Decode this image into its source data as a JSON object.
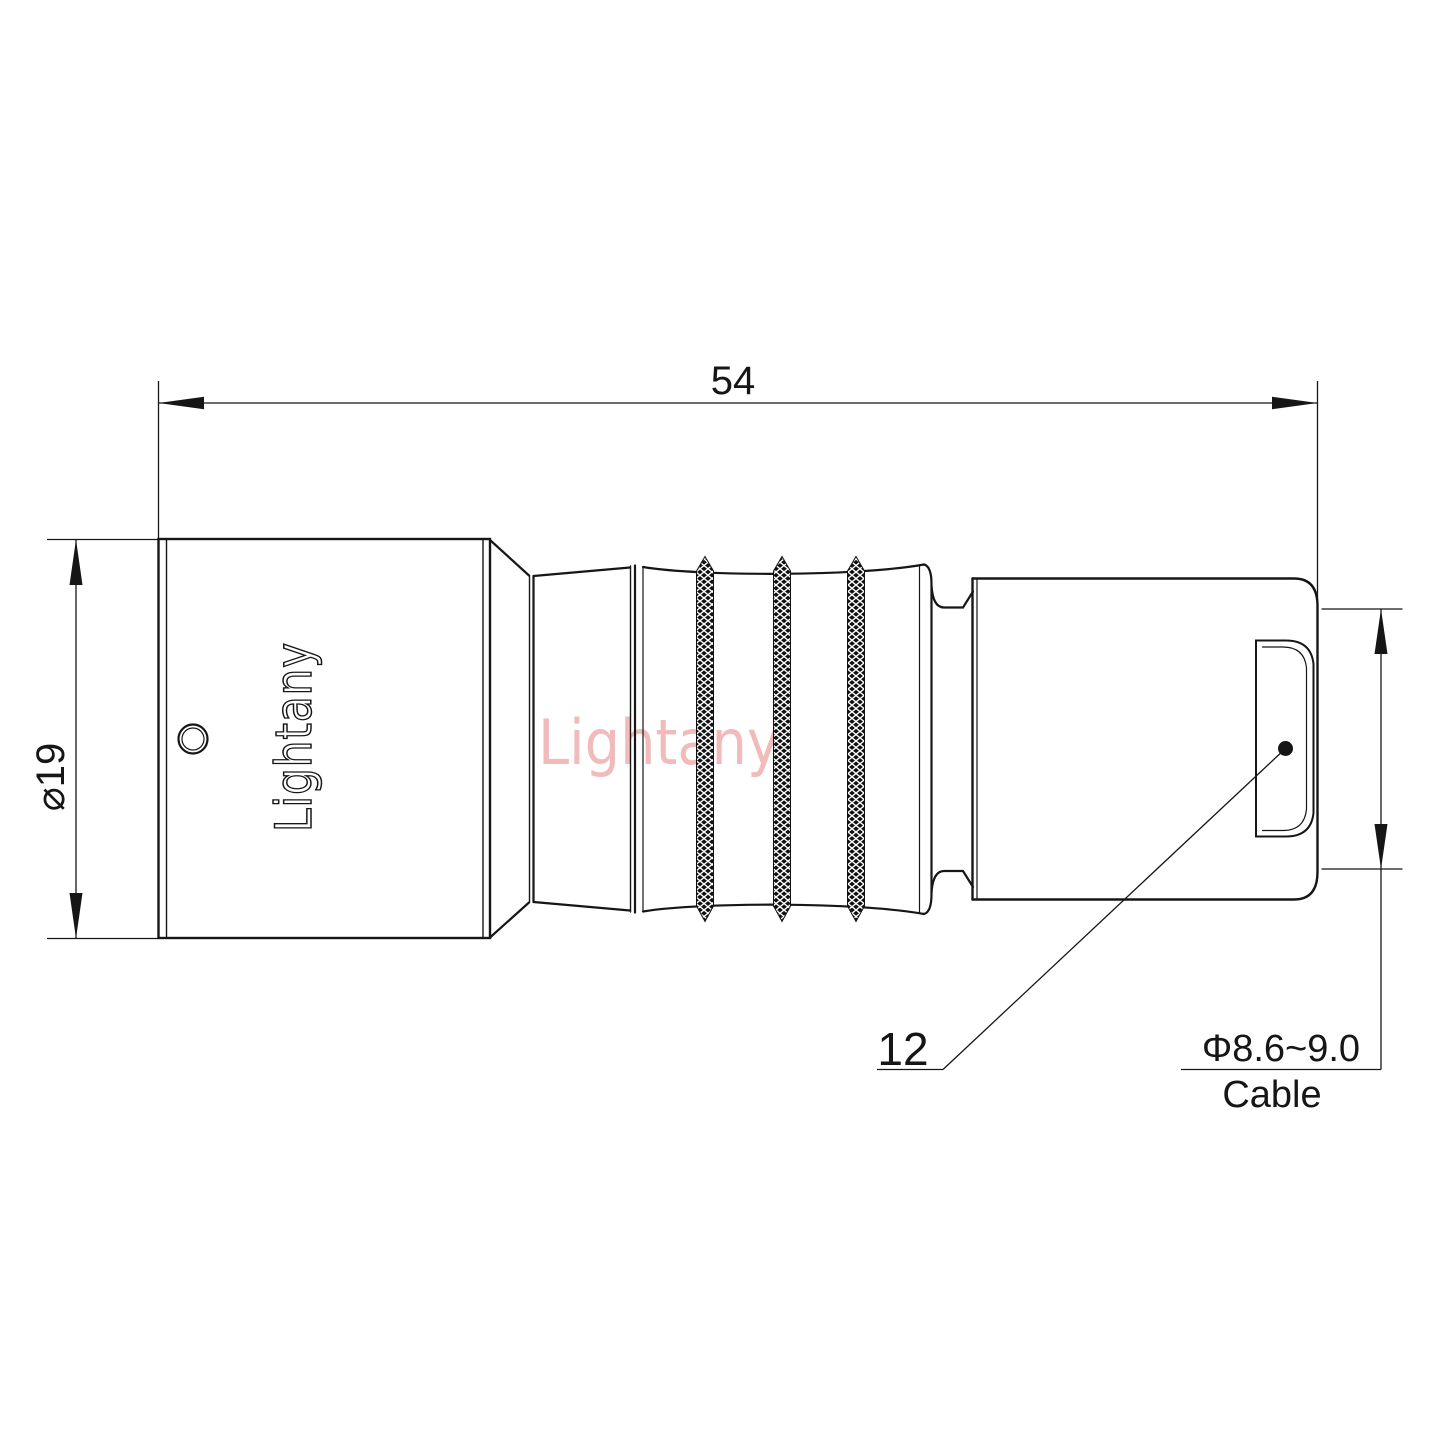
{
  "drawing": {
    "dim_length": "54",
    "dim_diameter": "⌀19",
    "dim_boot": "12",
    "dim_cable_range": "Φ8.6~9.0",
    "cable_label": "Cable"
  },
  "branding": {
    "body_logo": "Lightany",
    "watermark": "Lightany"
  },
  "colors": {
    "line": "#161616",
    "knurl": "#111111",
    "watermark": "#eeafaf"
  }
}
